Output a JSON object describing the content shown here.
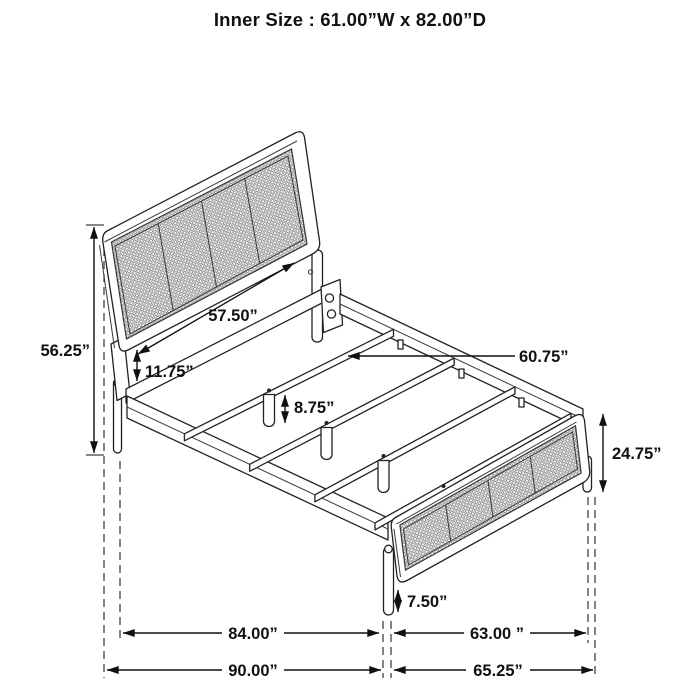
{
  "title": "Inner Size : 61.00”W x 82.00”D",
  "labels": {
    "headboard_height": "56.25”",
    "headboard_inner_width": "57.50”",
    "rail_height": "11.75”",
    "slat_leg_height": "8.75”",
    "slat_length": "60.75”",
    "footboard_height": "24.75”",
    "footboard_leg_height": "7.50”",
    "inner_length": "84.00”",
    "footboard_inner_width": "63.00 ”",
    "outer_length": "90.00”",
    "footboard_outer_width": "65.25”"
  }
}
